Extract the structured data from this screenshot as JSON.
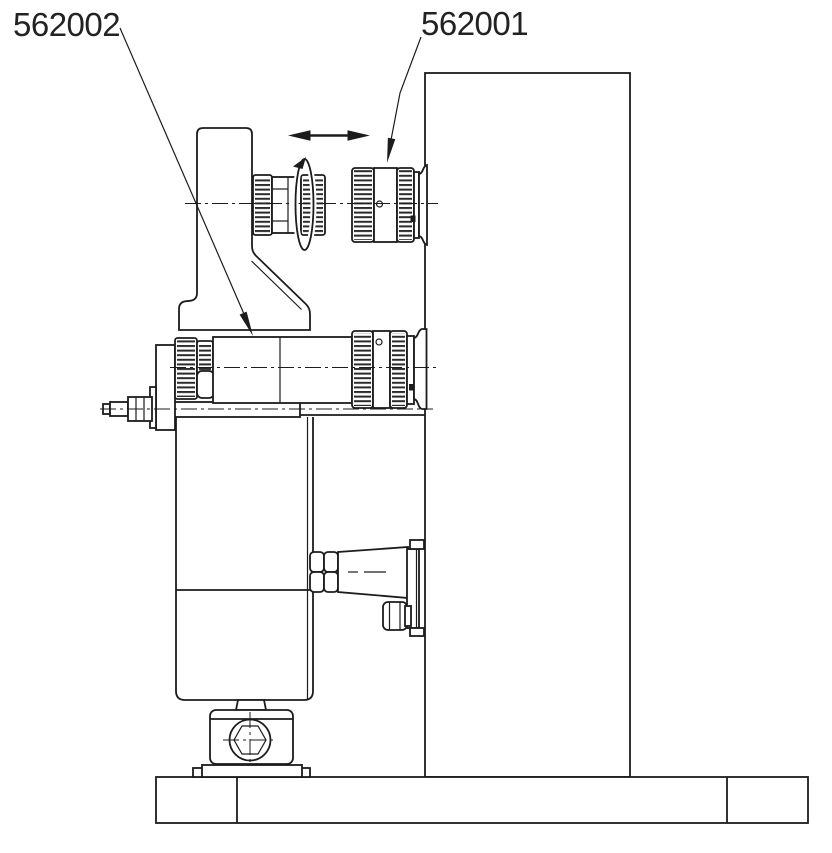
{
  "diagram": {
    "type": "technical-drawing",
    "description": "Side view of a micrometer positioning stage mounted on an L-shaped stand",
    "labels": {
      "part_562002": "562002",
      "part_562001": "562001"
    }
  }
}
